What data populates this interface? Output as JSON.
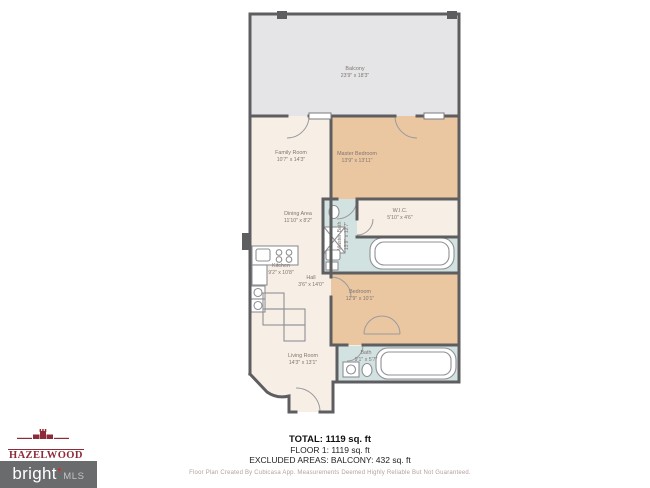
{
  "rooms": {
    "balcony": {
      "name": "Balcony",
      "dims": "23'9\" x 18'3\""
    },
    "family_room": {
      "name": "Family Room",
      "dims": "10'7\" x 14'3\""
    },
    "master_bedroom": {
      "name": "Master Bedroom",
      "dims": "13'9\" x 13'11\""
    },
    "dining_area": {
      "name": "Dining Area",
      "dims": "11'10\" x 8'2\""
    },
    "wic": {
      "name": "W.I.C.",
      "dims": "5'10\" x 4'6\""
    },
    "master_bath": {
      "name": "Master Bath",
      "dims": "13'9\" x 12'7\""
    },
    "kitchen": {
      "name": "Kitchen",
      "dims": "9'2\" x 10'8\""
    },
    "hall": {
      "name": "Hall",
      "dims": "3'6\" x 14'0\""
    },
    "bedroom": {
      "name": "Bedroom",
      "dims": "12'9\" x 10'1\""
    },
    "bath": {
      "name": "Bath",
      "dims": "9'1\" x 5'7\""
    },
    "living_room": {
      "name": "Living Room",
      "dims": "14'3\" x 13'1\""
    }
  },
  "summary": {
    "total": "TOTAL: 1119 sq. ft",
    "floor": "FLOOR 1: 1119 sq. ft",
    "excluded": "EXCLUDED AREAS: BALCONY: 432 sq. ft",
    "disclaimer": "Floor Plan Created By Cubicasa App. Measurements Deemed Highly Reliable But Not Guaranteed."
  },
  "branding": {
    "hazelwood_title": "HAZELWOOD",
    "hazelwood_subtitle": "REALTY GROUP",
    "bright": "bright",
    "mls": "MLS"
  },
  "colors": {
    "wall": "#5e5e61",
    "balcony_fill": "#e5e5e7",
    "room_cream": "#f7efe6",
    "room_tan": "#eac7a1",
    "room_blue": "#d2e2e1",
    "label_text": "#7e7672",
    "brand_red": "#8e2b39",
    "mls_gray": "#6a6b6d"
  }
}
